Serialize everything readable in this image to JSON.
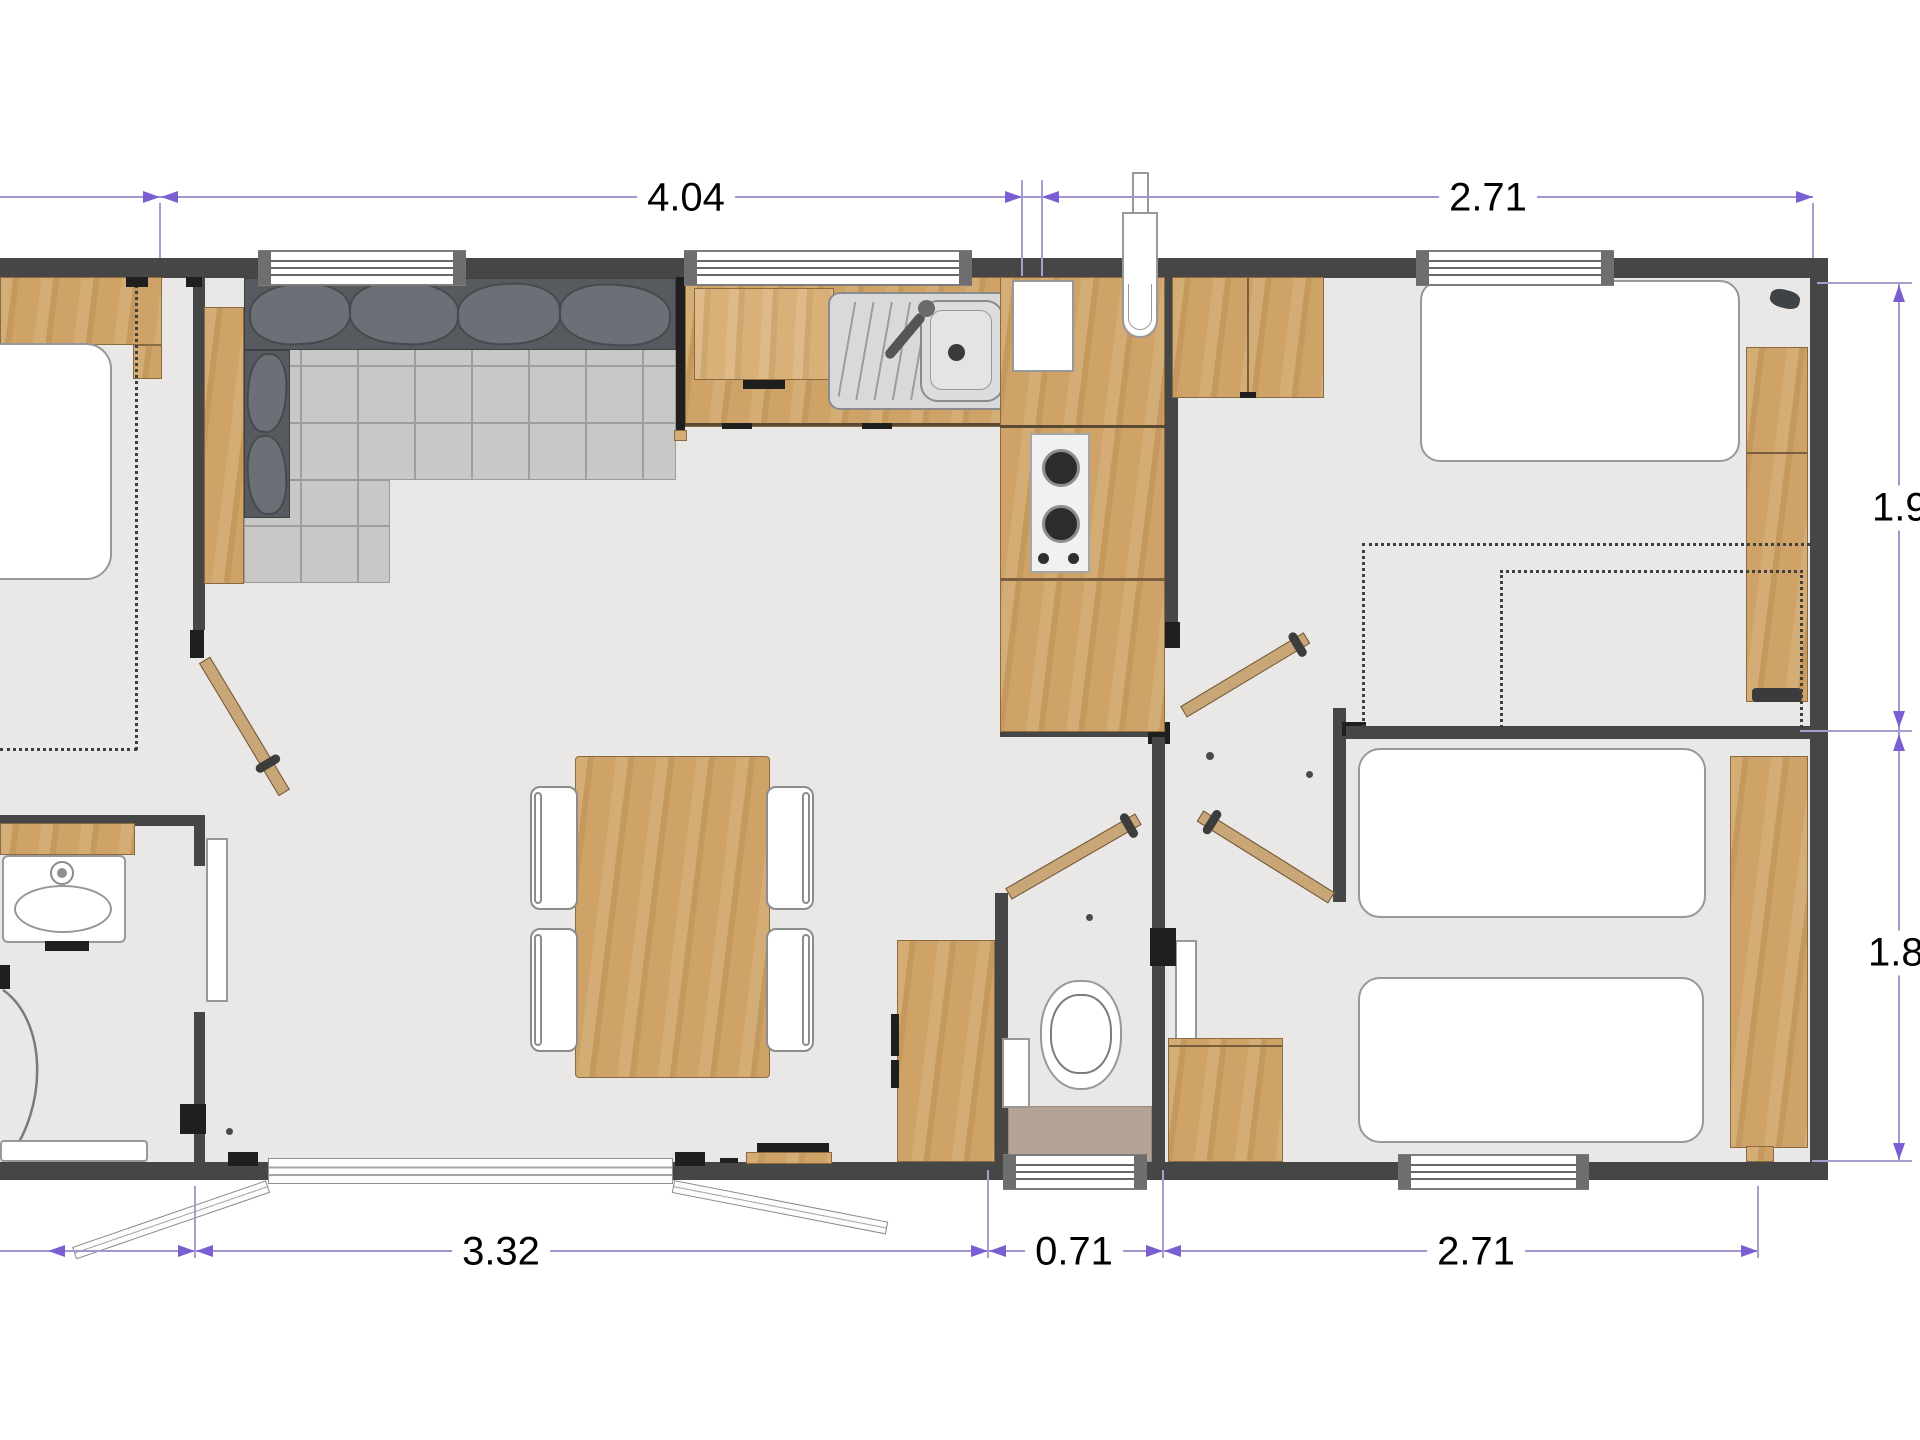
{
  "dimensions": {
    "top_kitchen": "4.04",
    "top_bedroom": "2.71",
    "right_bedroom1": "1.90",
    "right_bedroom2": "1.80",
    "bottom_living": "3.32",
    "bottom_wc": "0.71",
    "bottom_bedroom": "2.71"
  },
  "colors": {
    "wall": "#464646",
    "wood": "#cfa367",
    "floor": "#e9e8e6",
    "dimension_line": "#a395cf",
    "dimension_arrow": "#7b5ed1",
    "wc_floor": "#b3a395",
    "sofa": "#c8c9c7"
  }
}
